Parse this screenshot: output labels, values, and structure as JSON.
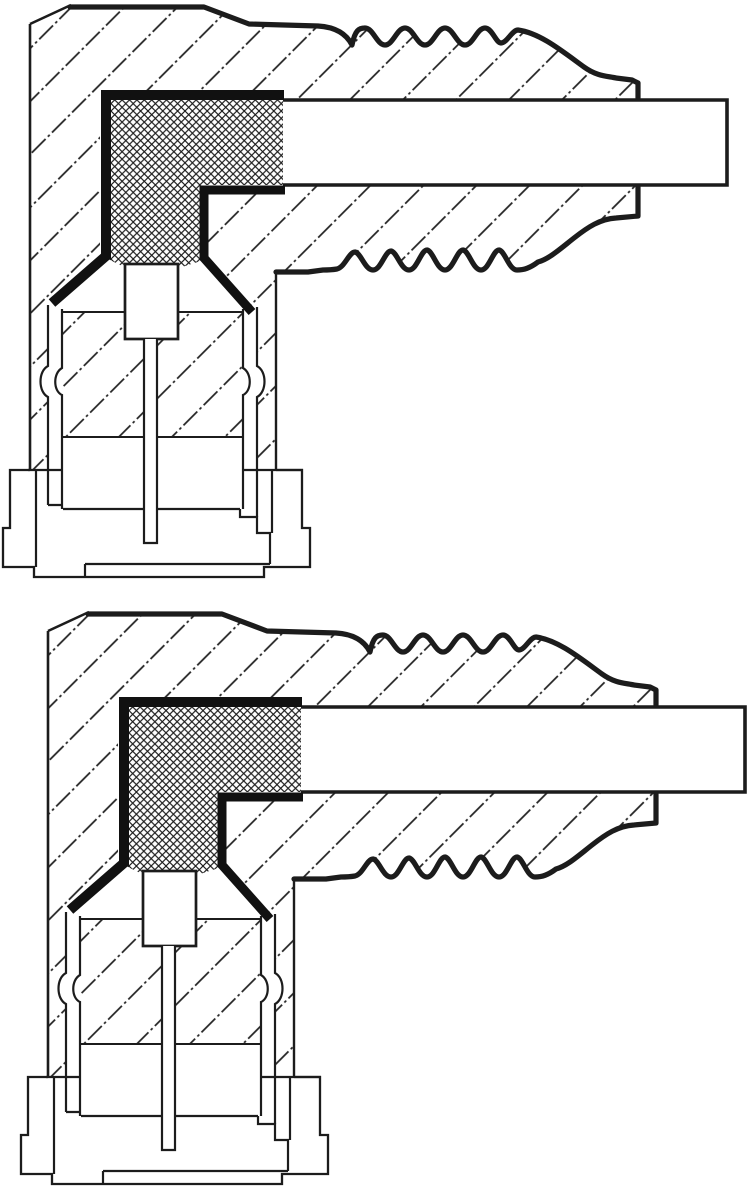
{
  "page": {
    "background_color": "#ffffff",
    "width_px": 750,
    "height_px": 1190
  },
  "diagram": {
    "kind": "technical cross-section line drawing",
    "figure_count": 2,
    "colors": {
      "line": "#1c1c1c",
      "shield_fill": "#111111",
      "body_fill": "#ffffff"
    },
    "patterns": {
      "body_material": "diagonal-chain-hatch",
      "seal_insert": "cross-hatch-mesh"
    },
    "figures": [
      {
        "position": "top",
        "aria_label": "Cross-section of a right-angle cable connector: diagonally hatched housing with corrugated strain relief, white cable entering from the right, thick black angled shield contact around a cross-hatched seal block, insulator with center pin and stepped base socket"
      },
      {
        "position": "bottom",
        "aria_label": "Second cross-section of the same right-angle cable connector, shifted lower right: hatched housing, corrugated strain relief, cross-hatched seal block with angled shield contact, insulator with center pin and stepped base socket"
      }
    ]
  }
}
